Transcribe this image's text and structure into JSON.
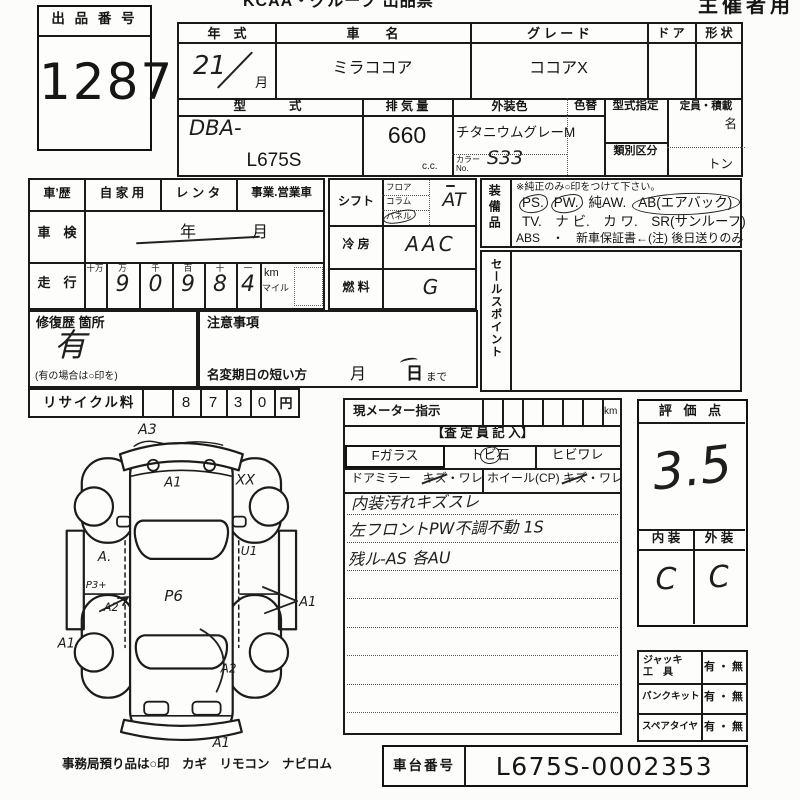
{
  "header": {
    "title": "KCAA・グループ 出品票",
    "audience": "主催者用"
  },
  "auction": {
    "label": "出 品 番 号",
    "number": "1287"
  },
  "vehicle": {
    "year_label": "年　式",
    "year_value": "21",
    "month_suffix": "月",
    "name_label": "車　　名",
    "name_value": "ミラココア",
    "grade_label": "グ レ ー ド",
    "grade_value": "ココアX",
    "door_label": "ド ア",
    "shape_label": "形 状",
    "model_label": "型　　式",
    "model_prefix": "DBA-",
    "model_code": "L675S",
    "displacement_label": "排 気 量",
    "displacement_value": "660",
    "displacement_unit": "c.c.",
    "ext_color_label": "外装色",
    "ext_color_value": "チタニウムグレーM",
    "color_change_label": "色替",
    "color_no_label_1": "カラー",
    "color_no_label_2": "No.",
    "color_no_value": "S33",
    "type_designation_label": "型式指定",
    "class_section_label": "類別区分",
    "capacity_label": "定員・積載",
    "capacity_persons": "名",
    "capacity_tons": "トン"
  },
  "history": {
    "label": "車’歴",
    "private": "自 家 用",
    "rental": "レ ン タ",
    "business": "事業.営業車"
  },
  "inspection": {
    "label": "車　検",
    "year": "年",
    "month": "月"
  },
  "mileage": {
    "label": "走　行",
    "headers": [
      "十万",
      "万",
      "千",
      "百",
      "十",
      "一"
    ],
    "digits": [
      "",
      "9",
      "0",
      "9",
      "8",
      "4"
    ],
    "unit_km": "km",
    "unit_mile": "マイル"
  },
  "repair": {
    "label": "修復歴 箇所",
    "value": "有",
    "note": "(有の場合は○印を)"
  },
  "caution": {
    "label": "注意事項",
    "deadline_label": "名変期日の短い方",
    "month": "月",
    "day": "日",
    "until": "まで"
  },
  "controls": {
    "shift_label": "シフト",
    "shift_floor": "フロア",
    "shift_column": "コラム",
    "shift_panel": "パネル",
    "shift_value": "AT",
    "ac_label": "冷 房",
    "ac_value": "AAC",
    "fuel_label": "燃 料",
    "fuel_value": "G"
  },
  "equipment": {
    "label": "装備品",
    "note": "※純正のみ○印をつけて下さい。",
    "ps": "PS.",
    "pw": "PW.",
    "aw": "純AW.",
    "ab": "AB(エアバック)",
    "line2": "TV.　ナ ビ.　カ ワ.　SR(サンルーフ)",
    "line3": "ABS　・　新車保証書←(注) 後日送りのみ"
  },
  "sales_point": {
    "label": "セールスポイント"
  },
  "recycle": {
    "label": "リサイクル料",
    "digits": [
      "",
      "8",
      "7",
      "3",
      "0"
    ],
    "unit": "円"
  },
  "meter": {
    "label": "現メーター指示",
    "unit": "km"
  },
  "assessor": {
    "header": "【査 定 員 記 入】",
    "f_glass": "Fガラス",
    "stone_a": "ト",
    "stone_b": "ビ",
    "stone_c": "石",
    "crack": "ヒビワレ",
    "mirror_a": "ドアミラー",
    "mirror_b": "キズ",
    "mirror_c": "・ワレ",
    "wheel_a": "ホイール(CP)",
    "wheel_b": "キズ",
    "wheel_c": "・ワレ",
    "notes": [
      "内装汚れキズスレ",
      "左フロントPW不調不動 1S",
      "残ル-AS 各AU"
    ]
  },
  "evaluation": {
    "label": "評 価 点",
    "score": "3.5",
    "interior_label": "内 装",
    "exterior_label": "外 装",
    "interior_grade": "C",
    "exterior_grade": "C"
  },
  "accessories": {
    "jack_label_1": "ジャッキ",
    "jack_label_2": "工　具",
    "jack_value": "有 ・ 無",
    "puncture_label": "パンクキット",
    "puncture_value": "有 ・ 無",
    "spare_label": "スペアタイヤ",
    "spare_value": "有 ・ 無"
  },
  "chassis": {
    "label": "車台番号",
    "value": "L675S-0002353"
  },
  "footer": {
    "note": "事務局預り品は○印　カギ　リモコン　ナビロム"
  },
  "diagram": {
    "marks": [
      {
        "label": "A3"
      },
      {
        "label": "A1"
      },
      {
        "label": "XX"
      },
      {
        "label": "A."
      },
      {
        "label": "U1"
      },
      {
        "label": "P3+"
      },
      {
        "label": "A2"
      },
      {
        "label": "P6"
      },
      {
        "label": "A1"
      },
      {
        "label": "A1"
      },
      {
        "label": "A2"
      },
      {
        "label": "A1"
      }
    ]
  }
}
